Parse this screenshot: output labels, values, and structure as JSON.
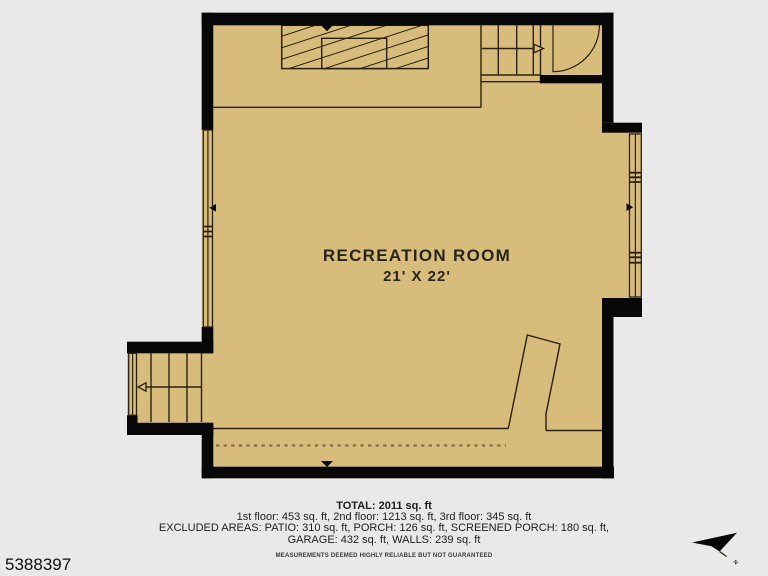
{
  "plan": {
    "room": {
      "name": "RECREATION ROOM",
      "dimensions": "21' X 22'"
    },
    "compass_label": "N"
  },
  "footer": {
    "total": "TOTAL: 2011 sq. ft",
    "floors": "1st floor: 453 sq. ft, 2nd floor: 1213 sq. ft, 3rd floor: 345 sq. ft",
    "excluded_line1": "EXCLUDED AREAS: PATIO: 310 sq. ft, PORCH: 126 sq. ft, SCREENED PORCH: 180 sq. ft,",
    "excluded_line2": "GARAGE: 432 sq. ft, WALLS: 239 sq. ft",
    "disclaimer": "MEASUREMENTS DEEMED HIGHLY RELIABLE BUT NOT GUARANTEED"
  },
  "listing_id": "5388397",
  "colors": {
    "floor": "#d8bc7b",
    "wall": "#070707",
    "line": "#2a2110",
    "dashed": "#8a6d3c",
    "background": "#e9e9e9"
  }
}
